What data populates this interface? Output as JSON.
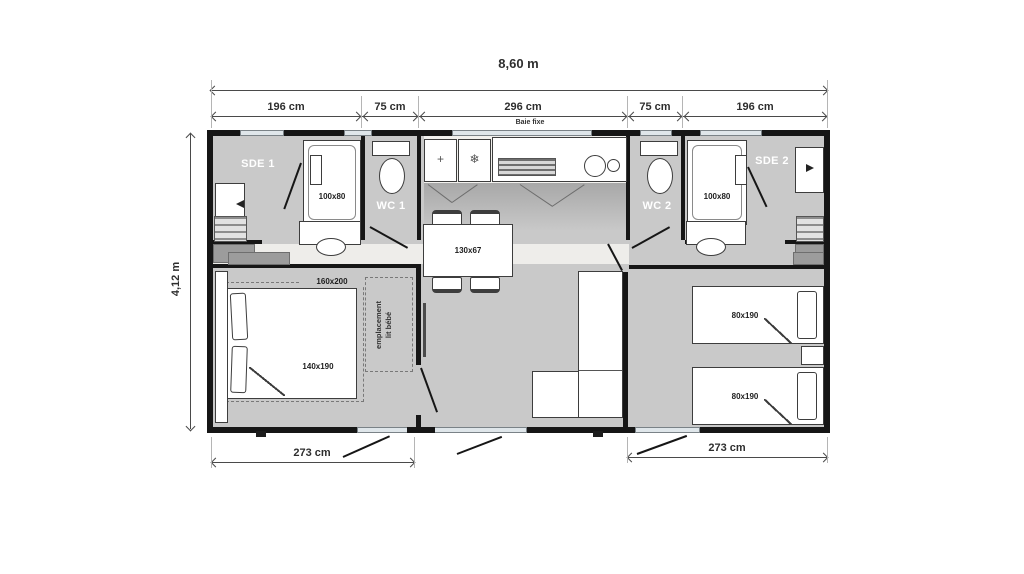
{
  "dimensions": {
    "overall_width": "8,60 m",
    "overall_depth": "4,12 m",
    "top_segments": [
      "196 cm",
      "75 cm",
      "296 cm",
      "75 cm",
      "196 cm"
    ],
    "bottom_left_width": "273 cm",
    "bottom_right_width": "273 cm"
  },
  "rooms": {
    "shower_room_1": "SDE 1",
    "toilet_1": "WC 1",
    "toilet_2": "WC 2",
    "shower_room_2": "SDE 2"
  },
  "annotations": {
    "bay_window": "Baie fixe",
    "baby_bed_area": "emplacement\nlit bébé"
  },
  "furniture_sizes": {
    "shower_1": "100x80",
    "shower_2": "100x80",
    "dining_table": "130x67",
    "master_bed": "140x190",
    "master_bed_zone": "160x200",
    "single_bed_1": "80x190",
    "single_bed_2": "80x190"
  },
  "icons": {
    "cabinet": "+",
    "fridge": "❄"
  },
  "colors": {
    "wall": "#161616",
    "floor": "#c9c9c9",
    "floor-light": "#f2f1ee",
    "corridor": "#eeedea",
    "window": "#dfe6ea",
    "outline": "#3d3d3d",
    "grey-block": "#9c9c9c",
    "dim": "#4a4a4a",
    "dim-text": "#2e2e2e",
    "room-label": "#ffffff"
  }
}
